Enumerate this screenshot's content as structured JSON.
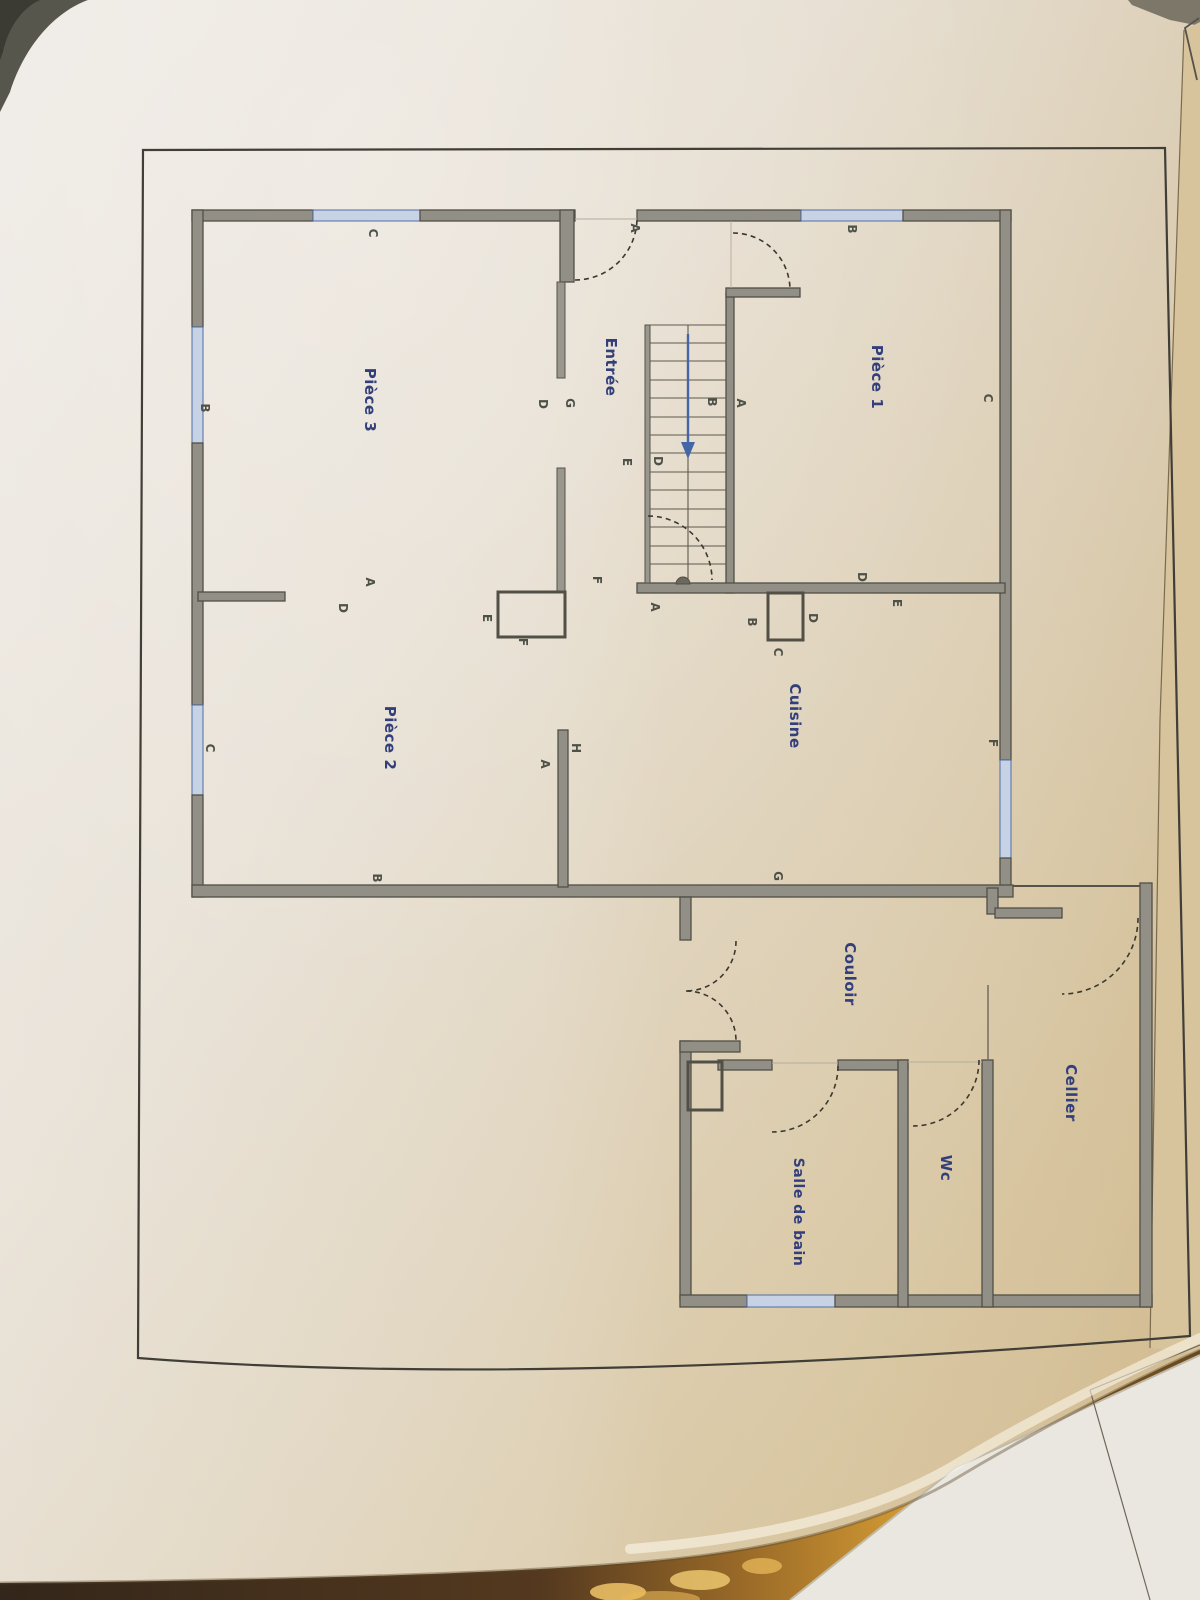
{
  "plan": {
    "rooms": [
      {
        "label": "Pièce 1"
      },
      {
        "label": "Pièce 2"
      },
      {
        "label": "Pièce 3"
      },
      {
        "label": "Entrée"
      },
      {
        "label": "Cuisine"
      },
      {
        "label": "Couloir"
      },
      {
        "label": "Cellier"
      },
      {
        "label": "Wc"
      },
      {
        "label": "Salle de bain"
      }
    ]
  },
  "ref_letters": [
    "C",
    "B",
    "A",
    "B",
    "C",
    "D",
    "G",
    "B",
    "A",
    "E",
    "D",
    "F",
    "E",
    "F",
    "A",
    "D",
    "D",
    "E",
    "A",
    "B",
    "D",
    "C",
    "F",
    "C",
    "H",
    "A",
    "B",
    "G"
  ],
  "colors": {
    "paper_light": "#eee9e1",
    "paper_tan": "#d4bd92",
    "wall_fill": "#918f86",
    "wall_edge": "#514f46",
    "label_blue": "#333f7a",
    "letter_color": "#4e5147",
    "window_blue": "#4e6ea6",
    "arrow_blue": "#4466a8",
    "frame_line": "#403e37",
    "wood": "#cf9733"
  }
}
